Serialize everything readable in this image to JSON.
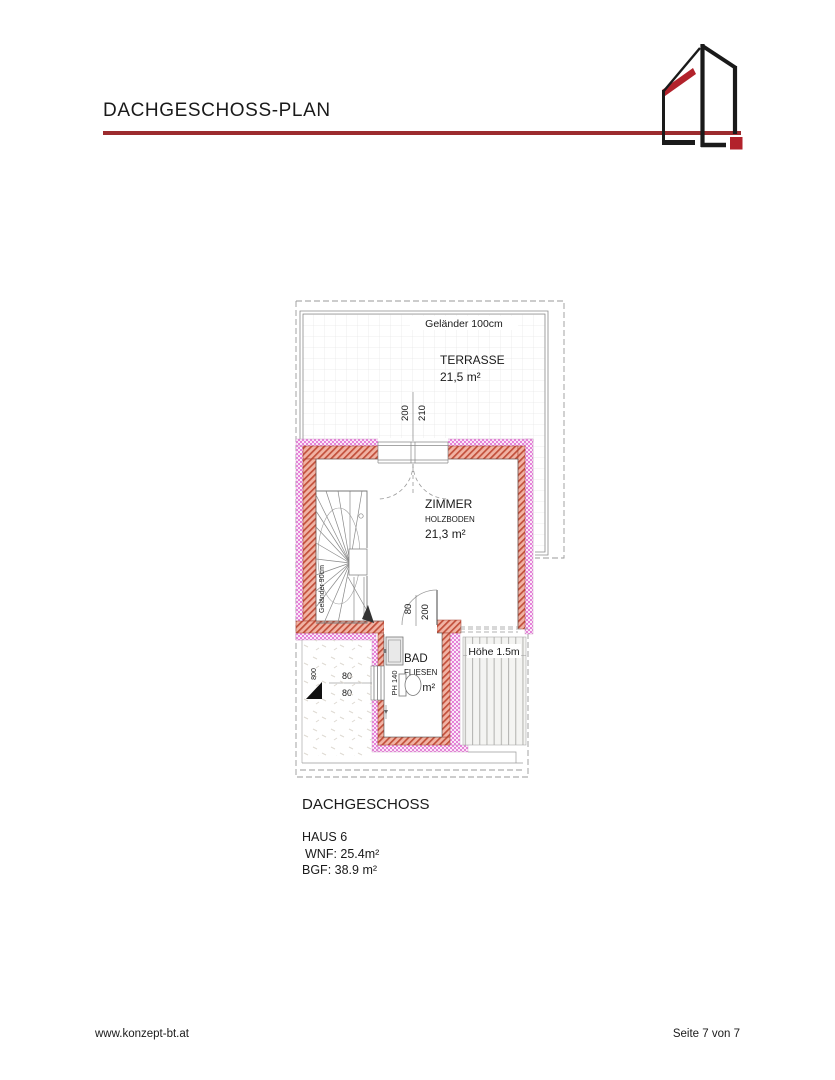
{
  "header": {
    "title": "DACHGESCHOSS-PLAN"
  },
  "plan": {
    "terrasse": {
      "railing_label": "Geländer 100cm",
      "name": "TERRASSE",
      "area": "21,5 m²"
    },
    "terrace_door": {
      "dim_width": "200",
      "dim_height": "210"
    },
    "zimmer": {
      "name": "ZIMMER",
      "floor": "HOLZBODEN",
      "area": "21,3 m²"
    },
    "stairs": {
      "railing_label": "Geländer 90cm"
    },
    "bad_door": {
      "dim_width": "80",
      "dim_height": "200"
    },
    "bad": {
      "name": "BAD",
      "floor": "FLIESEN",
      "area": "4,1 m²",
      "parapet_label": "PH 140"
    },
    "bad_window": {
      "dim_top": "80",
      "dim_bottom": "80"
    },
    "roof_area": {
      "dim": "800"
    },
    "low_height_area": {
      "label": "Höhe 1.5m"
    }
  },
  "caption": {
    "title": "DACHGESCHOSS",
    "house": "HAUS 6",
    "wnf": "WNF: 25.4m²",
    "bgf": "BGF: 38.9 m²"
  },
  "footer": {
    "website": "www.konzept-bt.at",
    "page": "Seite 7 von 7"
  },
  "colors": {
    "accent_rule": "#9c2b2e",
    "logo_red": "#b2222b",
    "logo_black": "#1a1a1a",
    "wall_insulation_pink": "#e583d8",
    "wall_masonry_red": "#c24f3a"
  }
}
